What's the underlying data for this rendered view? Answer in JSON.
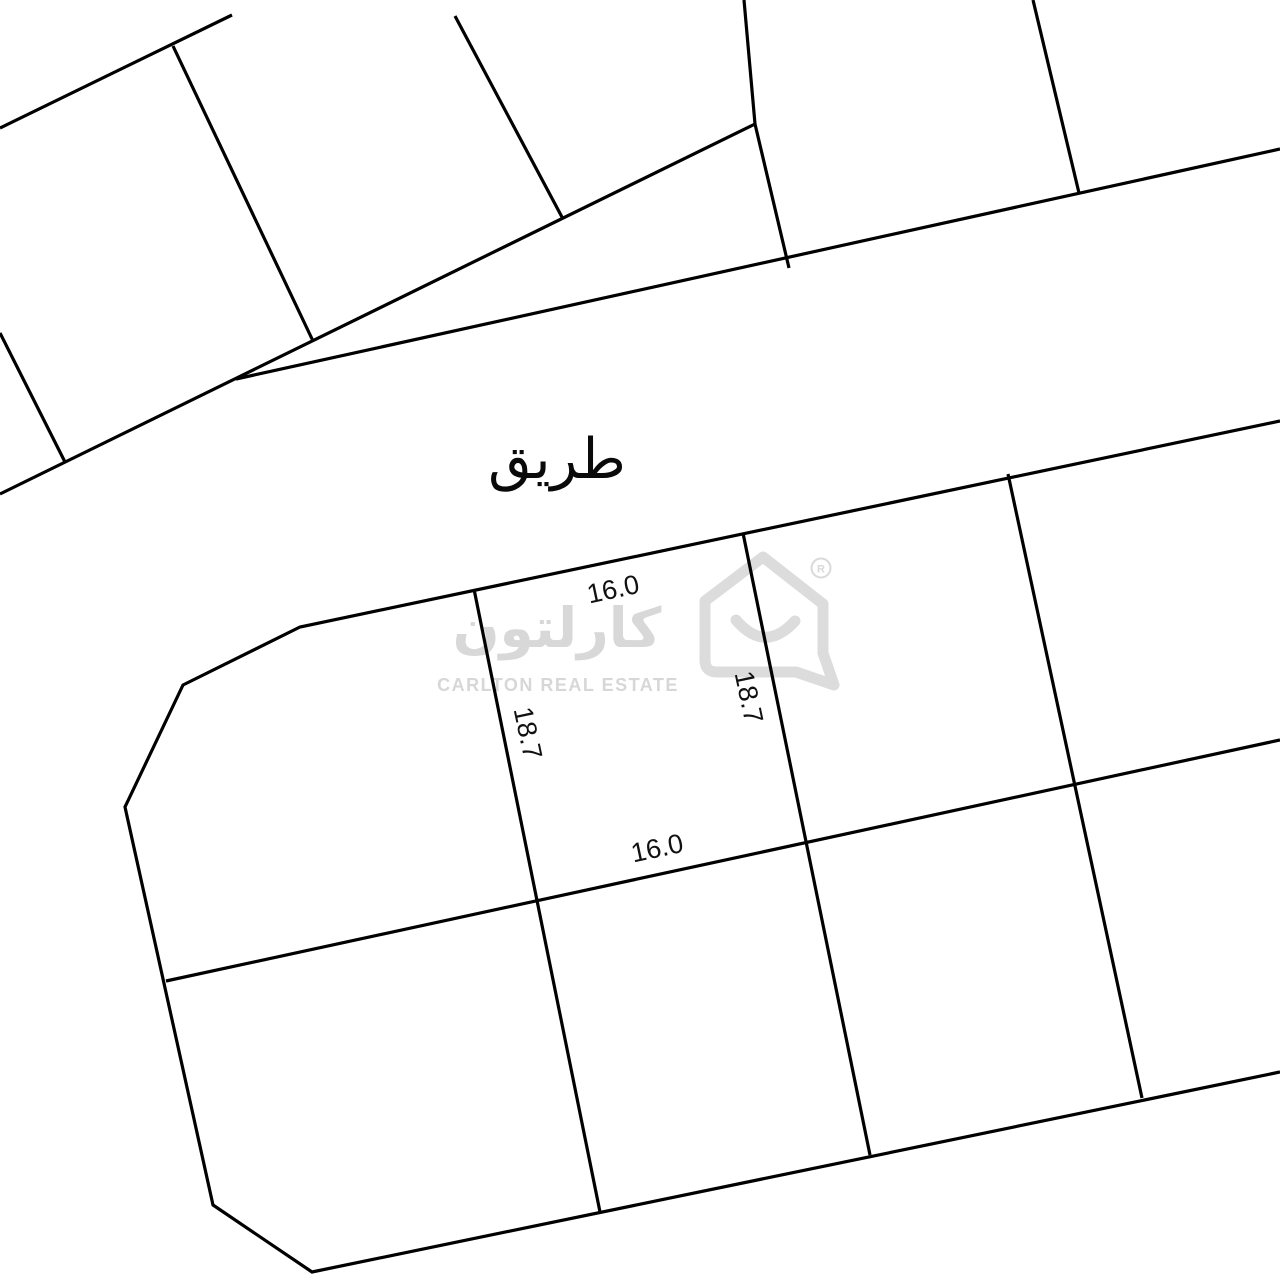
{
  "page": {
    "width": 1280,
    "height": 1277,
    "background_color": "#ffffff"
  },
  "map": {
    "stroke_color": "#000000",
    "stroke_width": 3.2,
    "road_label": {
      "text": "طريق",
      "x": 557,
      "y": 478,
      "rotate": 0,
      "font_size": 56
    },
    "dimension_labels": [
      {
        "name": "dim-top-frontage",
        "text": "16.0",
        "x": 615,
        "y": 598,
        "rotate": -12
      },
      {
        "name": "dim-left-depth",
        "text": "18.7",
        "x": 519,
        "y": 735,
        "rotate": 78
      },
      {
        "name": "dim-right-depth",
        "text": "18.7",
        "x": 740,
        "y": 699,
        "rotate": 78
      },
      {
        "name": "dim-bottom-frontage",
        "text": "16.0",
        "x": 659,
        "y": 857,
        "rotate": -12
      }
    ],
    "parcel_lines": [
      {
        "name": "upper-left-block-top-boundary",
        "points": [
          [
            0,
            128
          ],
          [
            232,
            15
          ]
        ]
      },
      {
        "name": "upper-left-plot-divider",
        "points": [
          [
            173,
            46
          ],
          [
            313,
            341
          ]
        ]
      },
      {
        "name": "upper-left-short-divider",
        "points": [
          [
            0,
            333
          ],
          [
            65,
            462
          ]
        ]
      },
      {
        "name": "upper-left-block-bottom-boundary",
        "points": [
          [
            0,
            494
          ],
          [
            755,
            124
          ]
        ]
      },
      {
        "name": "road-upper-edge",
        "points": [
          [
            236,
            379
          ],
          [
            1280,
            149
          ]
        ]
      },
      {
        "name": "upper-middle-plot-divider",
        "points": [
          [
            455,
            16
          ],
          [
            563,
            219
          ]
        ]
      },
      {
        "name": "upper-center-plot-divider",
        "points": [
          [
            744,
            0
          ],
          [
            755,
            124
          ],
          [
            789,
            268
          ]
        ]
      },
      {
        "name": "upper-right-plot-divider",
        "points": [
          [
            1033,
            0
          ],
          [
            1079,
            193
          ]
        ]
      },
      {
        "name": "lower-block-outline",
        "points": [
          [
            1280,
            421
          ],
          [
            300,
            627
          ],
          [
            183,
            685
          ],
          [
            125,
            807
          ],
          [
            213,
            1205
          ],
          [
            312,
            1272
          ],
          [
            1280,
            1072
          ]
        ]
      },
      {
        "name": "lower-block-middle-line",
        "points": [
          [
            166,
            981
          ],
          [
            1280,
            740
          ]
        ]
      },
      {
        "name": "central-plot-left-boundary",
        "points": [
          [
            474,
            589
          ],
          [
            600,
            1212
          ]
        ]
      },
      {
        "name": "central-plot-right-boundary",
        "points": [
          [
            743,
            533
          ],
          [
            870,
            1155
          ]
        ]
      },
      {
        "name": "lower-right-plot-divider",
        "points": [
          [
            1008,
            474
          ],
          [
            1142,
            1098
          ]
        ]
      }
    ]
  },
  "watermark": {
    "logo_text_ar": "كارلتون",
    "logo_text_en": "CARLTON REAL ESTATE",
    "registered_letter": "R",
    "color": "#d8d8d8"
  }
}
